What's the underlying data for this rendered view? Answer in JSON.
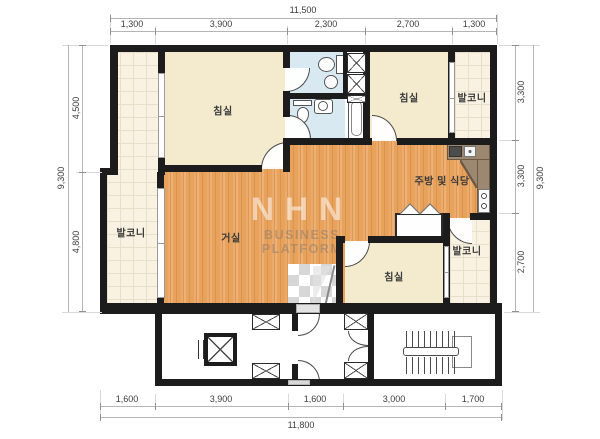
{
  "watermark": {
    "logo": "NHN",
    "subtitle": "BUSINESS PLATFORM"
  },
  "rooms": {
    "bedroom_top_left": "침실",
    "bedroom_top_right": "침실",
    "bedroom_bottom": "침실",
    "living_room": "거실",
    "kitchen_dining": "주방 및 식당",
    "balcony_left": "발코니",
    "balcony_top_right": "발코니",
    "balcony_bottom_right": "발코니"
  },
  "dimensions": {
    "top": {
      "total": "11,500",
      "segments": [
        "1,300",
        "3,900",
        "2,300",
        "2,700",
        "1,300"
      ]
    },
    "bottom": {
      "total": "11,800",
      "segments": [
        "1,600",
        "3,900",
        "1,600",
        "3,000",
        "1,700"
      ]
    },
    "left": {
      "total": "9,300",
      "segments": [
        "4,500",
        "4,800"
      ]
    },
    "right": {
      "total": "9,300",
      "segments": [
        "3,300",
        "3,300",
        "2,700"
      ]
    }
  },
  "colors": {
    "wall": "#1c1c1c",
    "wood_floor": "#e9a25c",
    "bedroom_floor": "#f4ebcf",
    "balcony_tile": "#f9f2e2",
    "bathroom": "#d9e9f2",
    "counter": "#9c8870"
  }
}
